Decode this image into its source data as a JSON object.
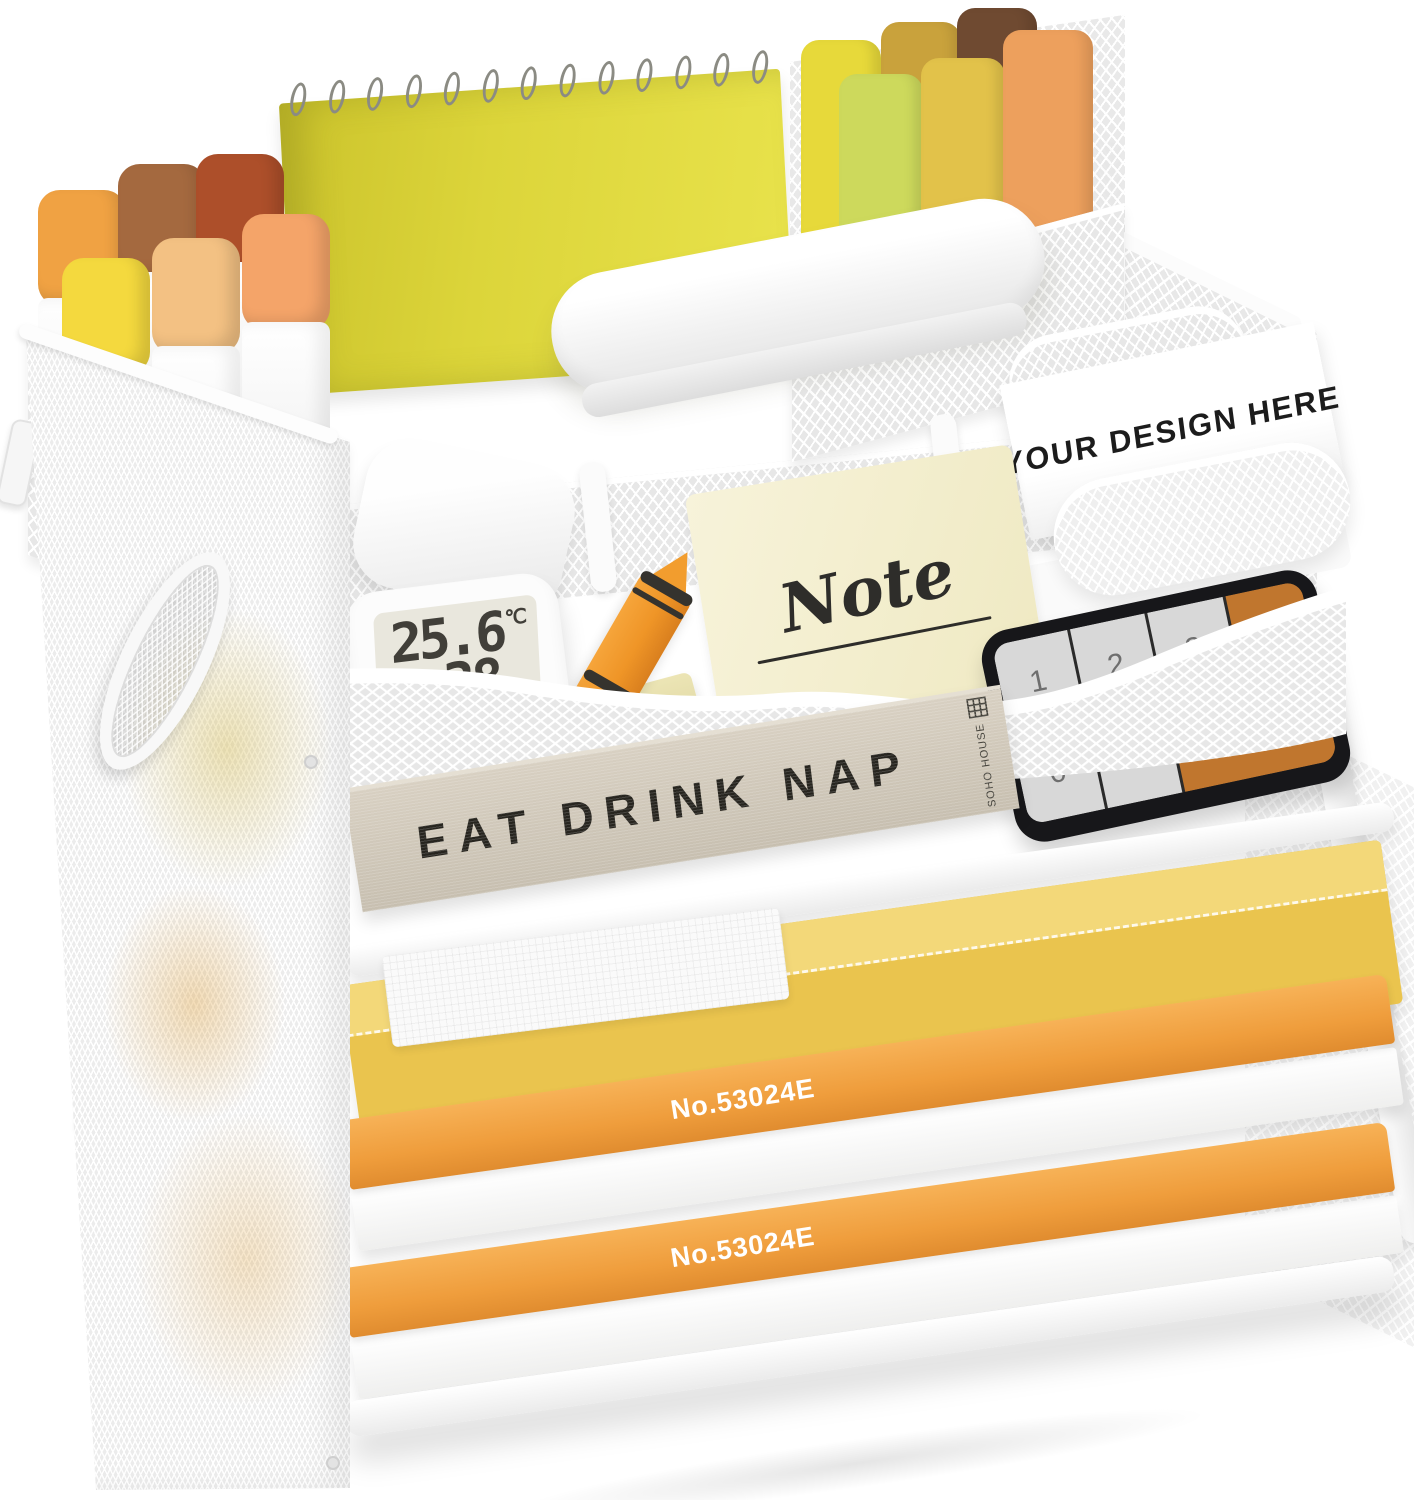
{
  "scene": {
    "description": "White mesh desktop file organizer with stationery, product photo on white background"
  },
  "palette": {
    "frame_white": "#ffffff",
    "mesh_gray": "#e7e7e7",
    "notebook_yellow": "#dcd53a",
    "folder_yellow": "#eac44e",
    "paper_edge_orange": "#ef9d3c",
    "crayon_orange": "#ef9527",
    "calculator_key_orange": "#c0762e",
    "book_linen": "#cfc7b9",
    "note_cream": "#f3efd2",
    "glue_green": "#3d7a52",
    "glue_beige": "#ece5b6",
    "marker_cap_colors": [
      "#f0a243",
      "#a4693f",
      "#ad4f2a",
      "#f4d93e",
      "#f3c183",
      "#f4a469"
    ],
    "highlighter_colors": [
      "#e7d93a",
      "#c9a23c",
      "#6f4a31",
      "#cdd95c",
      "#e2c24a",
      "#eda05d"
    ]
  },
  "middle_tray": {
    "glue_stick": {
      "brand": "UHU stic",
      "type_label": "Glue Stick"
    },
    "hygrometer": {
      "temperature": "25.6",
      "temperature_unit": "℃",
      "humidity": "38",
      "humidity_unit": "%"
    },
    "eraser": {
      "grade": "4B",
      "brand": "真彩®TruColor"
    },
    "sticky_note": {
      "label": "Note"
    },
    "business_card": {
      "text": "YOUR DESIGN HERE"
    }
  },
  "letter_trays": {
    "calculator_keys": [
      "1",
      "2",
      "3",
      "+",
      "0",
      ".",
      "="
    ],
    "book": {
      "title": "EAT DRINK NAP",
      "publisher": "SOHO HOUSE"
    },
    "paper_labels": [
      "No.53024E",
      "No.53024E"
    ]
  }
}
